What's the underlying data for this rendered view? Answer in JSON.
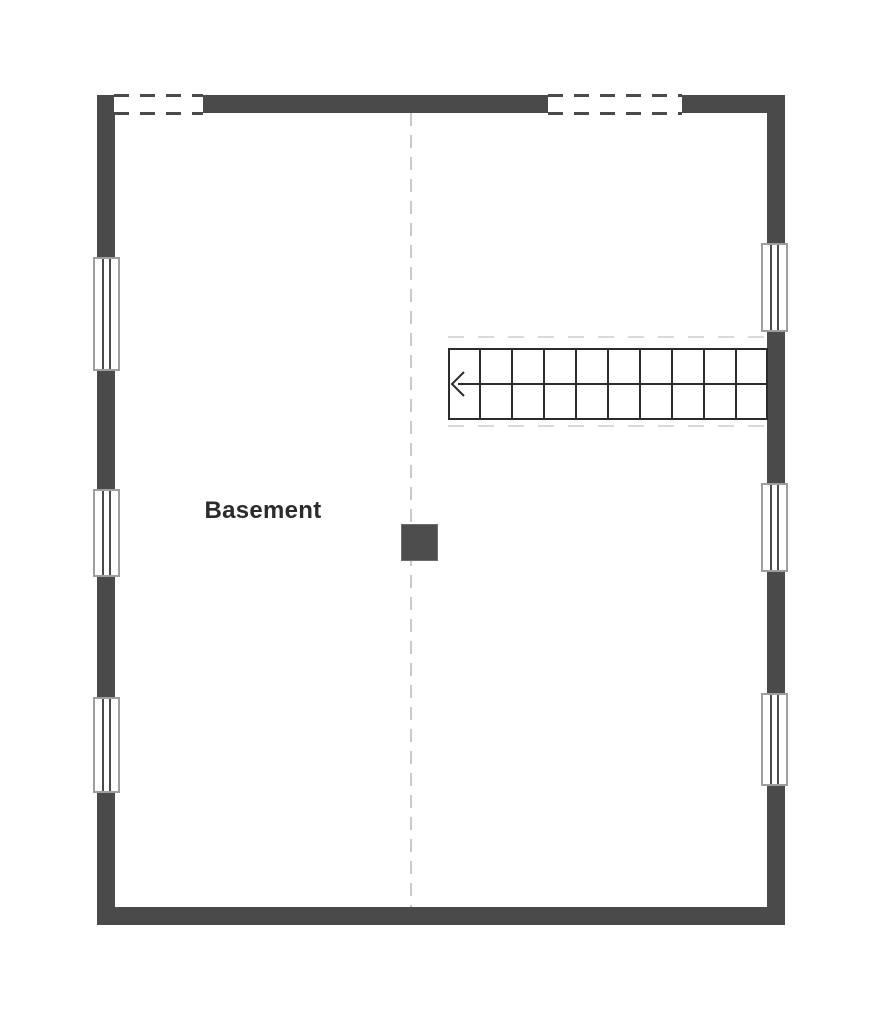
{
  "floor_plan": {
    "room_label": "Basement",
    "stairs": {
      "treads": 10,
      "arrow_direction": "left"
    },
    "counts": {
      "left_wall_windows": 3,
      "right_wall_windows": 3,
      "top_wall_openings": 2,
      "support_columns": 1
    },
    "colors": {
      "wall": "#4a4a4a",
      "stair_line": "#2c2c2c",
      "window_frame": "#9e9e9e",
      "centerline_dash": "#c9c9c9",
      "faint_dash": "#d9d9d9",
      "label": "#2b2b2b",
      "column": "#4d4d4d",
      "background": "#ffffff"
    }
  }
}
